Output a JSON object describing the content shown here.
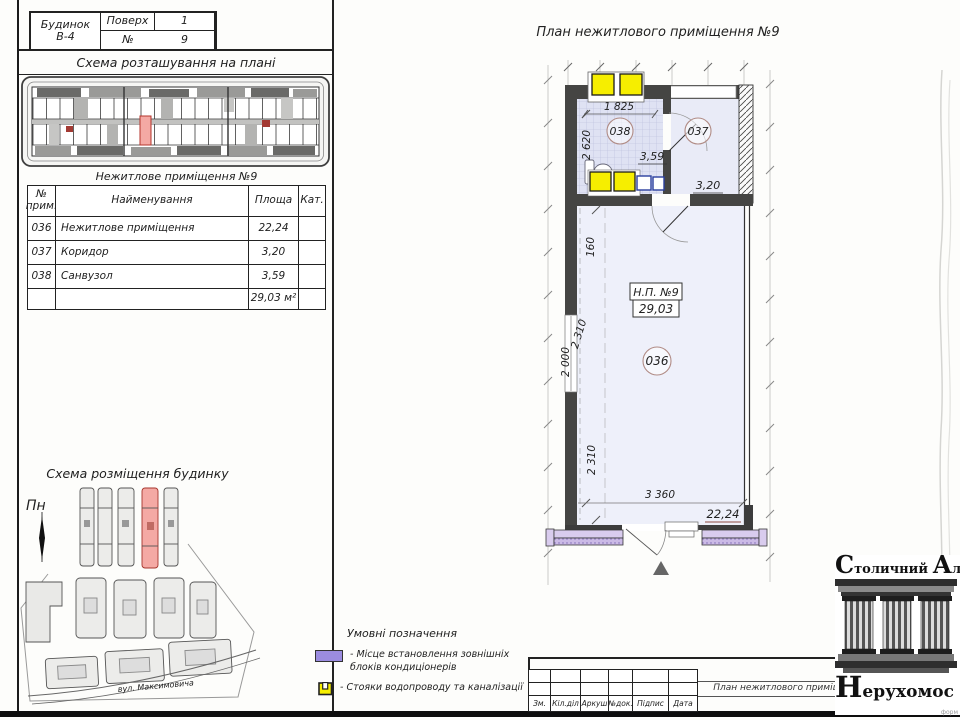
{
  "sheet": {
    "header": {
      "building_label": "Будинок",
      "building_value": "В-4",
      "floor_label": "Поверх",
      "floor_value": "1",
      "num_label": "№",
      "num_value": "9"
    },
    "location_scheme": {
      "title": "Схема розташування на плані"
    },
    "premises_table": {
      "title": "Нежитлове приміщення №9",
      "col_num_l1": "№",
      "col_num_l2": "прим.",
      "col_name": "Найменування",
      "col_area": "Площа",
      "col_cat": "Кат.",
      "rows": [
        {
          "num": "036",
          "name": "Нежитлове приміщення",
          "area": "22,24",
          "cat": ""
        },
        {
          "num": "037",
          "name": "Коридор",
          "area": "3,20",
          "cat": ""
        },
        {
          "num": "038",
          "name": "Санвузол",
          "area": "3,59",
          "cat": ""
        }
      ],
      "total_area": "29,03 м²"
    },
    "site_scheme": {
      "title": "Схема розміщення будинку",
      "north": "Пн",
      "street": "вул. Максимовича"
    },
    "plan": {
      "title": "План нежитлового приміщення №9",
      "unit_label": "Н.П. №9",
      "unit_area": "29,03",
      "rooms": {
        "r036": "036",
        "a036": "22,24",
        "r037": "037",
        "a037": "3,20",
        "r038": "038",
        "a038": "3,59"
      },
      "dims": {
        "w_bath": "1 825",
        "h_bath": "2 620",
        "d160": "160",
        "d2310a": "2 310",
        "d2000": "2 000",
        "d2310b": "2 310",
        "w_room": "3 360"
      }
    },
    "legend": {
      "title": "Умовні позначення",
      "ac_line1": "- Місце встановлення зовнішніх",
      "ac_line2": "блоків кондиціонерів",
      "riser_text": "- Стояки водопроводу та каналізації"
    },
    "titleblock": {
      "doc_title": "План нежитлового приміщення №9",
      "cols": [
        "Зм.",
        "Кіл.діл",
        "Аркуш",
        "№док.",
        "Підпис",
        "Дата"
      ]
    },
    "logo": {
      "word1": "Столичний",
      "word2": "Аль",
      "word3": "Нерухомос",
      "note": "форм"
    },
    "colors": {
      "highlight": "#f4a9a4",
      "highlight_border": "#b5352c",
      "ac_purple": "#9b8ce0",
      "riser_yellow": "#f6ee00",
      "tile": "#dfe2f3",
      "wall": "#454543"
    }
  }
}
